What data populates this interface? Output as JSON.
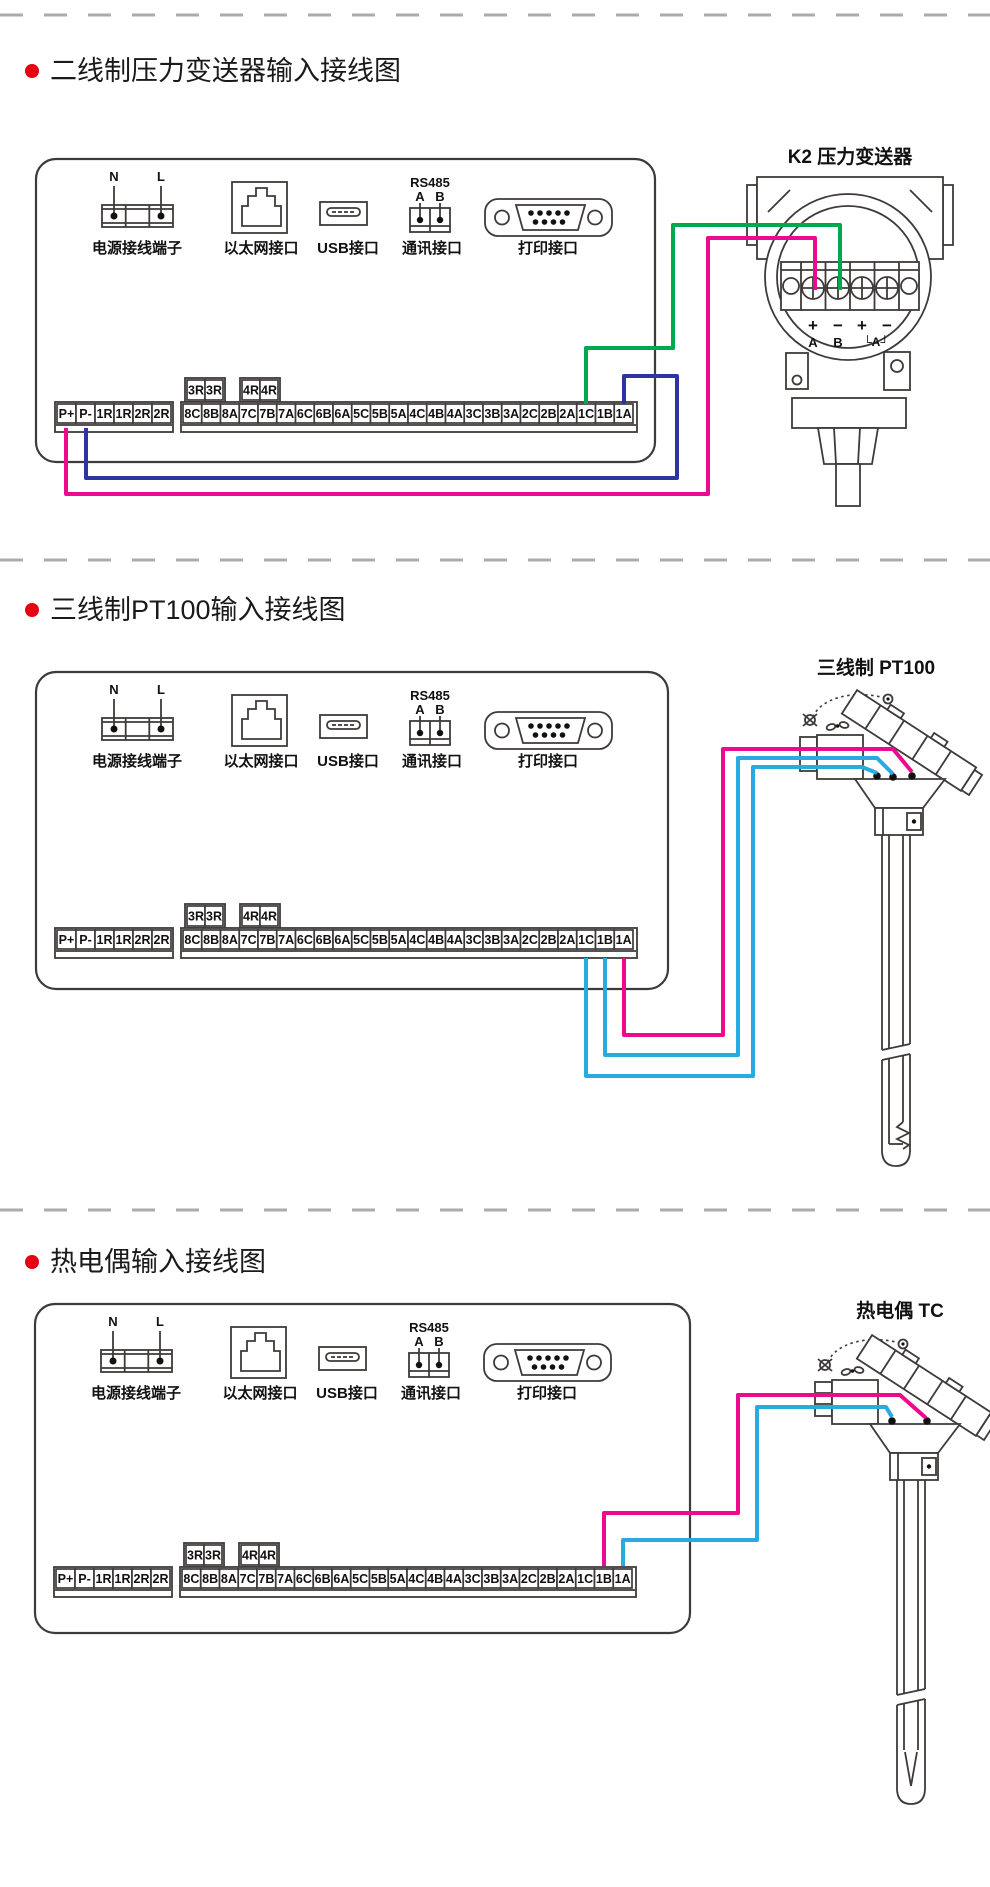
{
  "colors": {
    "magenta": "#EC0A8E",
    "blue": "#2E35A3",
    "green": "#00A94F",
    "light_blue": "#29ABE2",
    "outline": "#3E3A39",
    "separator": "#ABABAB",
    "bullet": "#E60012",
    "text": "#111111"
  },
  "sections": [
    {
      "title": "二线制压力变送器输入接线图",
      "device_label": "K2 压力变送器",
      "wires": [
        {
          "from": "P+",
          "to": "变送器 + (A)",
          "color": "magenta"
        },
        {
          "from": "P-",
          "to": "1A",
          "color": "blue"
        },
        {
          "from": "1C",
          "to": "变送器 − (B)",
          "color": "green"
        }
      ]
    },
    {
      "title": "三线制PT100输入接线图",
      "device_label": "三线制  PT100",
      "wires": [
        {
          "from": "1A",
          "to": "PT100",
          "color": "magenta"
        },
        {
          "from": "1B",
          "to": "PT100",
          "color": "light_blue"
        },
        {
          "from": "1C",
          "to": "PT100",
          "color": "light_blue"
        }
      ]
    },
    {
      "title": "热电偶输入接线图",
      "device_label": "热电偶  TC",
      "wires": [
        {
          "from": "1B",
          "to": "热电偶",
          "color": "magenta"
        },
        {
          "from": "1A",
          "to": "热电偶",
          "color": "light_blue"
        }
      ]
    }
  ],
  "panel": {
    "power_label": "电源接线端子",
    "power_pins": [
      "N",
      "L"
    ],
    "ethernet_label": "以太网接口",
    "usb_label": "USB接口",
    "comm_label": "通讯接口",
    "comm_protocol": "RS485",
    "comm_pins": [
      "A",
      "B"
    ],
    "print_label": "打印接口",
    "relay_labels": [
      "3R",
      "3R",
      "4R",
      "4R"
    ],
    "left_terminals": [
      "P+",
      "P-",
      "1R",
      "1R",
      "2R",
      "2R"
    ],
    "right_terminals": [
      "8C",
      "8B",
      "8A",
      "7C",
      "7B",
      "7A",
      "6C",
      "6B",
      "6A",
      "5C",
      "5B",
      "5A",
      "4C",
      "4B",
      "4A",
      "3C",
      "3B",
      "3A",
      "2C",
      "2B",
      "2A",
      "1C",
      "1B",
      "1A"
    ]
  },
  "transmitter": {
    "polarity_labels": [
      "+",
      "−",
      "+",
      "−"
    ],
    "pin_labels": [
      "A",
      "B",
      "└A┘"
    ]
  }
}
